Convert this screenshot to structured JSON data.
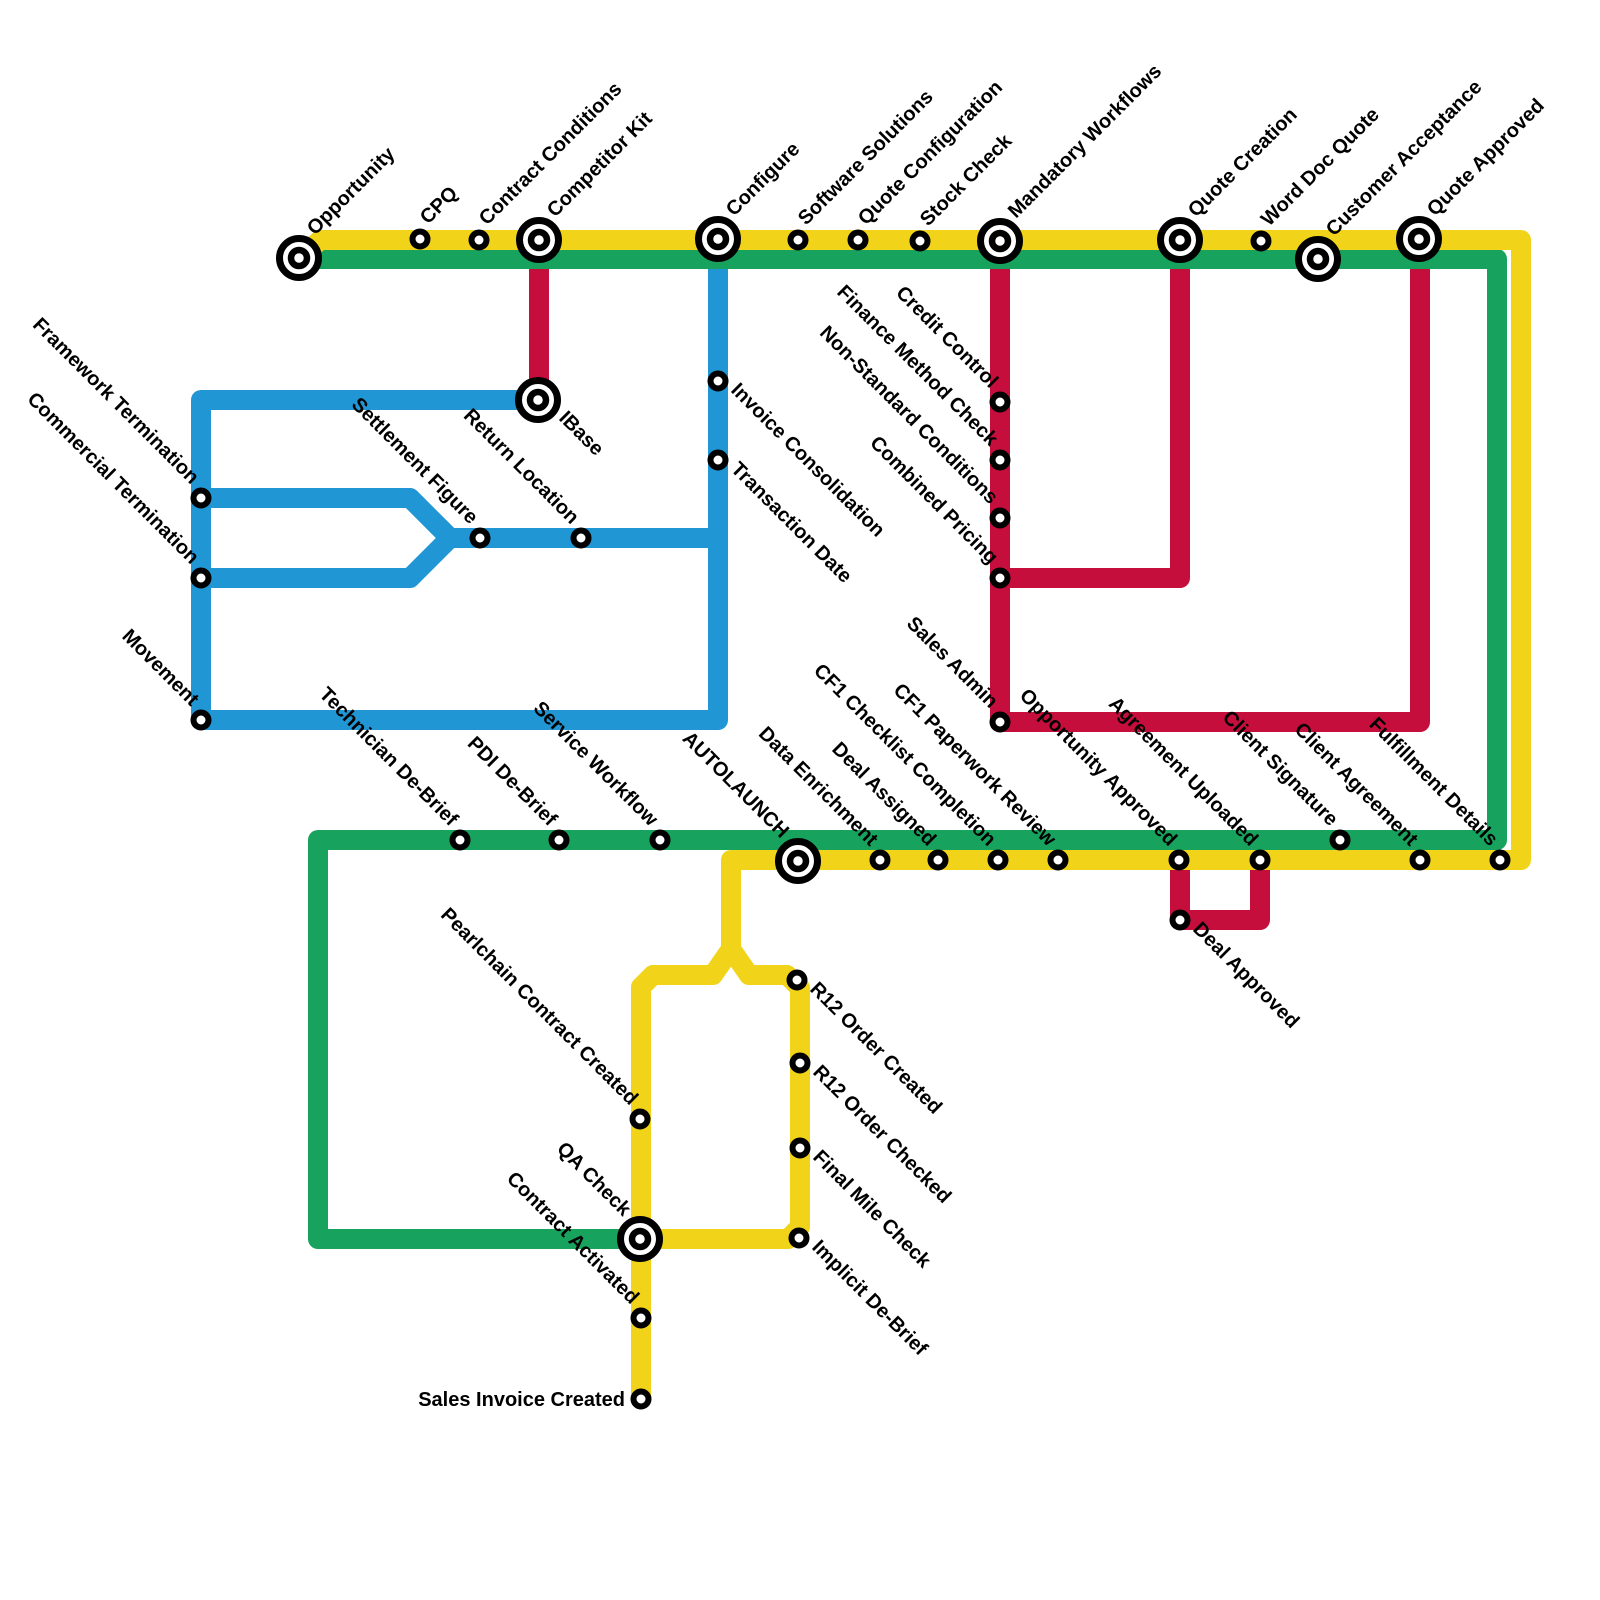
{
  "map": {
    "canvas": {
      "width": 1600,
      "height": 1600
    },
    "line_width": 20,
    "colors": {
      "yellow": "#F1D41A",
      "green": "#17A35D",
      "blue": "#2096D4",
      "red": "#C50E3C",
      "station_ring": "#000000",
      "station_fill": "#FFFFFF",
      "label": "#000000",
      "background": "#FFFFFF"
    },
    "lines": [
      {
        "id": "red-competitor-kit-ibase",
        "color": "red",
        "points": [
          [
            539,
            248
          ],
          [
            539,
            392
          ]
        ]
      },
      {
        "id": "red-mandatory-workflows-loop",
        "color": "red",
        "points": [
          [
            1000,
            248
          ],
          [
            1000,
            722
          ],
          [
            1420,
            722
          ],
          [
            1420,
            248
          ]
        ]
      },
      {
        "id": "red-quote-creation-connector",
        "color": "red",
        "points": [
          [
            1180,
            248
          ],
          [
            1180,
            578
          ],
          [
            1000,
            578
          ]
        ]
      },
      {
        "id": "red-deal-approved-dip",
        "color": "red",
        "points": [
          [
            1180,
            860
          ],
          [
            1180,
            920
          ],
          [
            1260,
            920
          ],
          [
            1260,
            860
          ]
        ]
      },
      {
        "id": "blue-main-loop",
        "color": "blue",
        "points": [
          [
            530,
            400
          ],
          [
            201,
            400
          ],
          [
            201,
            720
          ],
          [
            718,
            720
          ],
          [
            718,
            246
          ]
        ]
      },
      {
        "id": "blue-settlement-upper-branch",
        "color": "blue",
        "points": [
          [
            201,
            498
          ],
          [
            410,
            498
          ],
          [
            450,
            538
          ],
          [
            714,
            538
          ]
        ]
      },
      {
        "id": "blue-settlement-lower-branch",
        "color": "blue",
        "points": [
          [
            201,
            578
          ],
          [
            410,
            578
          ],
          [
            450,
            538
          ]
        ]
      },
      {
        "id": "green-main",
        "color": "green",
        "points": [
          [
            301,
            259
          ],
          [
            1497,
            259
          ],
          [
            1497,
            840
          ],
          [
            318,
            840
          ],
          [
            318,
            1239
          ],
          [
            640,
            1239
          ]
        ]
      },
      {
        "id": "yellow-main",
        "color": "yellow",
        "points": [
          [
            304,
            255
          ],
          [
            320,
            240
          ],
          [
            1521,
            240
          ],
          [
            1521,
            860
          ],
          [
            731,
            860
          ],
          [
            731,
            949
          ],
          [
            713,
            975
          ],
          [
            653,
            975
          ],
          [
            641,
            987
          ],
          [
            641,
            1399
          ]
        ]
      },
      {
        "id": "yellow-r12-loop",
        "color": "yellow",
        "points": [
          [
            731,
            949
          ],
          [
            749,
            975
          ],
          [
            787,
            975
          ],
          [
            800,
            988
          ],
          [
            800,
            1227
          ],
          [
            788,
            1239
          ],
          [
            641,
            1239
          ]
        ]
      }
    ],
    "stations": [
      {
        "id": "opportunity",
        "label": "Opportunity",
        "x": 299,
        "y": 258,
        "size": "big",
        "dir": "ne"
      },
      {
        "id": "cpq",
        "label": "CPQ",
        "x": 420,
        "y": 239,
        "size": "small",
        "dir": "ne"
      },
      {
        "id": "contract-conditions",
        "label": "Contract Conditions",
        "x": 479,
        "y": 240,
        "size": "small",
        "dir": "ne"
      },
      {
        "id": "competitor-kit",
        "label": "Competitor Kit",
        "x": 539,
        "y": 240,
        "size": "big",
        "dir": "ne"
      },
      {
        "id": "configure",
        "label": "Configure",
        "x": 718,
        "y": 239,
        "size": "big",
        "dir": "ne"
      },
      {
        "id": "software-solutions",
        "label": "Software Solutions",
        "x": 798,
        "y": 240,
        "size": "small",
        "dir": "ne"
      },
      {
        "id": "quote-configuration",
        "label": "Quote Configuration",
        "x": 858,
        "y": 240,
        "size": "small",
        "dir": "ne"
      },
      {
        "id": "stock-check",
        "label": "Stock Check",
        "x": 920,
        "y": 241,
        "size": "small",
        "dir": "ne"
      },
      {
        "id": "mandatory-workflows",
        "label": "Mandatory Workflows",
        "x": 1000,
        "y": 241,
        "size": "big",
        "dir": "ne"
      },
      {
        "id": "quote-creation",
        "label": "Quote Creation",
        "x": 1180,
        "y": 240,
        "size": "big",
        "dir": "ne"
      },
      {
        "id": "word-doc-quote",
        "label": "Word Doc Quote",
        "x": 1261,
        "y": 241,
        "size": "small",
        "dir": "ne"
      },
      {
        "id": "customer-acceptance",
        "label": "Customer Acceptance",
        "x": 1318,
        "y": 259,
        "size": "big",
        "dir": "ne"
      },
      {
        "id": "quote-approved",
        "label": "Quote Approved",
        "x": 1419,
        "y": 239,
        "size": "big",
        "dir": "ne"
      },
      {
        "id": "ibase",
        "label": "IBase",
        "x": 538,
        "y": 400,
        "size": "big",
        "dir": "se"
      },
      {
        "id": "invoice-consolidation",
        "label": "Invoice Consolidation",
        "x": 718,
        "y": 381,
        "size": "small",
        "dir": "se"
      },
      {
        "id": "transaction-date",
        "label": "Transaction Date",
        "x": 718,
        "y": 460,
        "size": "small",
        "dir": "se"
      },
      {
        "id": "framework-termination",
        "label": "Framework Termination",
        "x": 201,
        "y": 498,
        "size": "small",
        "dir": "nw"
      },
      {
        "id": "commercial-termination",
        "label": "Commercial Termination",
        "x": 201,
        "y": 578,
        "size": "small",
        "dir": "nw"
      },
      {
        "id": "settlement-figure",
        "label": "Settlement Figure",
        "x": 480,
        "y": 538,
        "size": "small",
        "dir": "nw"
      },
      {
        "id": "return-location",
        "label": "Return Location",
        "x": 581,
        "y": 538,
        "size": "small",
        "dir": "nw"
      },
      {
        "id": "movement",
        "label": "Movement",
        "x": 201,
        "y": 720,
        "size": "small",
        "dir": "nw"
      },
      {
        "id": "credit-control",
        "label": "Credit Control",
        "x": 1000,
        "y": 402,
        "size": "small",
        "dir": "nw"
      },
      {
        "id": "finance-method-check",
        "label": "Finance Method Check",
        "x": 1000,
        "y": 460,
        "size": "small",
        "dir": "nw"
      },
      {
        "id": "non-standard-conditions",
        "label": "Non-Standard Conditions",
        "x": 1000,
        "y": 518,
        "size": "small",
        "dir": "nw"
      },
      {
        "id": "combined-pricing",
        "label": "Combined Pricing",
        "x": 1000,
        "y": 578,
        "size": "small",
        "dir": "nw"
      },
      {
        "id": "sales-admin",
        "label": "Sales Admin",
        "x": 1000,
        "y": 722,
        "size": "small",
        "dir": "nw"
      },
      {
        "id": "technician-de-brief",
        "label": "Technician De-Brief",
        "x": 460,
        "y": 840,
        "size": "small",
        "dir": "nw"
      },
      {
        "id": "pdi-de-brief",
        "label": "PDI De-Brief",
        "x": 559,
        "y": 840,
        "size": "small",
        "dir": "nw"
      },
      {
        "id": "service-workflow",
        "label": "Service Workflow",
        "x": 660,
        "y": 840,
        "size": "small",
        "dir": "nw"
      },
      {
        "id": "autolaunch",
        "label": "AUTOLAUNCH",
        "x": 798,
        "y": 861,
        "size": "big",
        "dir": "nw"
      },
      {
        "id": "data-enrichment",
        "label": "Data Enrichment",
        "x": 880,
        "y": 860,
        "size": "small",
        "dir": "nw"
      },
      {
        "id": "deal-assigned",
        "label": "Deal Assigned",
        "x": 938,
        "y": 860,
        "size": "small",
        "dir": "nw"
      },
      {
        "id": "cf1-checklist-completion",
        "label": "CF1 Checklist Completion",
        "x": 998,
        "y": 860,
        "size": "small",
        "dir": "nw"
      },
      {
        "id": "cf1-paperwork-review",
        "label": "CF1 Paperwork Review",
        "x": 1058,
        "y": 860,
        "size": "small",
        "dir": "nw"
      },
      {
        "id": "opportunity-approved",
        "label": "Opportunity Approved",
        "x": 1179,
        "y": 860,
        "size": "small",
        "dir": "nw"
      },
      {
        "id": "agreement-uploaded",
        "label": "Agreement Uploaded",
        "x": 1260,
        "y": 860,
        "size": "small",
        "dir": "nw"
      },
      {
        "id": "client-signature",
        "label": "Client Signature",
        "x": 1340,
        "y": 840,
        "size": "small",
        "dir": "nw"
      },
      {
        "id": "client-agreement",
        "label": "Client Agreement",
        "x": 1420,
        "y": 860,
        "size": "small",
        "dir": "nw"
      },
      {
        "id": "fulfillment-details",
        "label": "Fulfillment Details",
        "x": 1500,
        "y": 860,
        "size": "small",
        "dir": "nw"
      },
      {
        "id": "deal-approved",
        "label": "Deal Approved",
        "x": 1180,
        "y": 920,
        "size": "small",
        "dir": "se"
      },
      {
        "id": "r12-order-created",
        "label": "R12 Order Created",
        "x": 797,
        "y": 980,
        "size": "small",
        "dir": "se"
      },
      {
        "id": "r12-order-checked",
        "label": "R12 Order Checked",
        "x": 800,
        "y": 1063,
        "size": "small",
        "dir": "se"
      },
      {
        "id": "final-mile-check",
        "label": "Final Mile Check",
        "x": 800,
        "y": 1148,
        "size": "small",
        "dir": "se"
      },
      {
        "id": "implicit-de-brief",
        "label": "Implicit De-Brief",
        "x": 799,
        "y": 1238,
        "size": "small",
        "dir": "se"
      },
      {
        "id": "pearlchain-contract-created",
        "label": "Pearlchain Contract Created",
        "x": 640,
        "y": 1119,
        "size": "small",
        "dir": "nw"
      },
      {
        "id": "qa-check",
        "label": "QA Check",
        "x": 640,
        "y": 1239,
        "size": "big",
        "dir": "nw"
      },
      {
        "id": "contract-activated",
        "label": "Contract Activated",
        "x": 641,
        "y": 1318,
        "size": "small",
        "dir": "nw"
      },
      {
        "id": "sales-invoice-created",
        "label": "Sales Invoice Created",
        "x": 641,
        "y": 1399,
        "size": "small",
        "dir": "w"
      }
    ]
  }
}
